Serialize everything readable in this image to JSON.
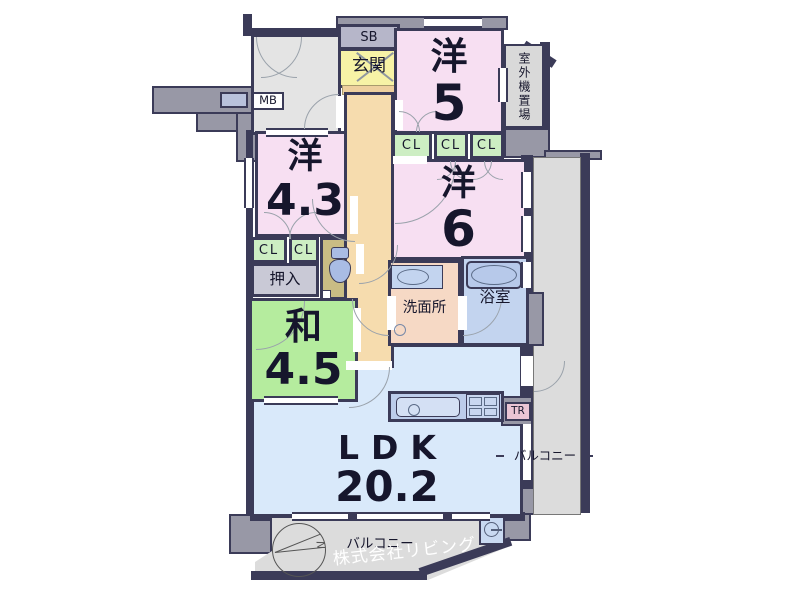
{
  "palette": {
    "wall_navy": "#3b3b58",
    "wall_gray": "#9898a6",
    "room_pink": "#f7dff2",
    "room_green": "#b5ec9e",
    "closet_green": "#cdeec3",
    "genkan_yellow": "#f7f3a6",
    "hall_orange": "#f6dcae",
    "step_orange": "#eed09e",
    "wash_salmon": "#f6d9c5",
    "bath_blue": "#c3d4ef",
    "ldk_blue": "#d9e9fa",
    "counter_blue": "#bcccea",
    "toilet_khaki": "#c9bc84",
    "balcony_gray": "#dcdcdc",
    "corridor_gray": "#e4e4e4",
    "sb_gray": "#b6b6c9",
    "tr_pink": "#eac5d4",
    "fixture_blue": "#a9bce4",
    "pipe_blue": "#b9c2dc"
  },
  "labels": {
    "sb": "SB",
    "mb": "MB",
    "tr": "TR",
    "cl": "CL",
    "genkan": "玄関",
    "outdoor_unit": "室外機置場",
    "yo5_name": "洋",
    "yo5_size": "5",
    "yo43_name": "洋",
    "yo43_size": "4.3",
    "yo6_name": "洋",
    "yo6_size": "6",
    "wa_name": "和",
    "wa_size": "4.5",
    "oshiire": "押入",
    "washroom": "洗面所",
    "bathroom": "浴室",
    "ldk_name": "LDK",
    "ldk_size": "20.2",
    "balcony_right": "バルコニー",
    "balcony_bottom": "バルコニー",
    "compass_n": "N",
    "watermark": "株式会社リビング"
  }
}
